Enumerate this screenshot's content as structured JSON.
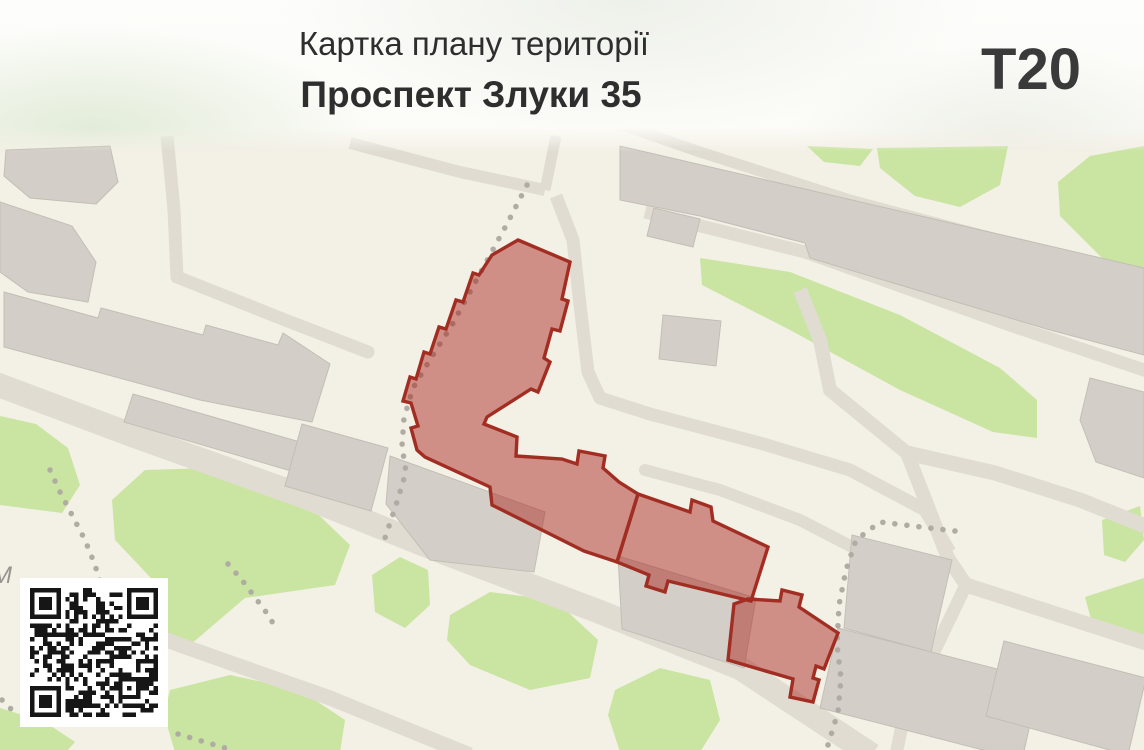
{
  "header": {
    "title": "Картка плану території",
    "subtitle": "Проспект Злуки 35",
    "sheet_code": "T20"
  },
  "map": {
    "street_label": "М",
    "qr_code": "qr-code"
  },
  "colors": {
    "map_bg": "#f3f0e6",
    "road": "#e0dcd2",
    "building": "#d3cfc8",
    "building_outline": "#c3beb5",
    "green": "#c9e5a1",
    "path_dot": "#b0aca3",
    "highlight_fill": "rgba(167,33,26,0.47)",
    "highlight_stroke": "#a22d22",
    "header_bg": "#fcfcfa",
    "text_primary": "#2e2e2e",
    "street_label_color": "#98948e",
    "qr_dark": "#161616",
    "qr_bg": "#ffffff"
  }
}
